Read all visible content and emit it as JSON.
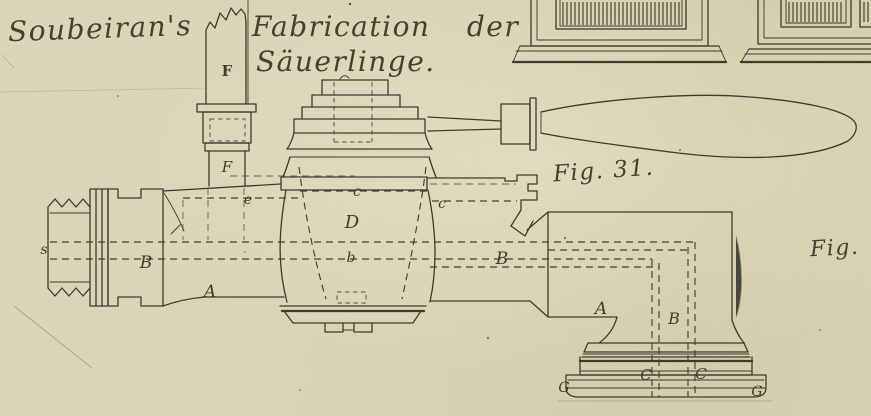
{
  "palette": {
    "paper": "#d8d3b6",
    "ink": "#3e3a2c",
    "faint_ink": "#8d8769",
    "label_ink": "#45402f"
  },
  "titles": {
    "artist": "Soubeiran's",
    "subject_line1": "Fabrication der",
    "subject_line2": "Säuerlinge."
  },
  "figure_labels": {
    "fig31": "Fig. 31.",
    "fig_partial": "Fig."
  },
  "part_labels": [
    {
      "text": "F",
      "x": 227,
      "y": 76,
      "size": 15,
      "variant": "upright"
    },
    {
      "text": "F",
      "x": 227,
      "y": 172,
      "size": 15,
      "variant": "italic"
    },
    {
      "text": "s",
      "x": 44,
      "y": 254,
      "size": 14,
      "variant": "italic"
    },
    {
      "text": "B",
      "x": 146,
      "y": 268,
      "size": 17,
      "variant": "italic"
    },
    {
      "text": "A",
      "x": 210,
      "y": 297,
      "size": 17,
      "variant": "italic"
    },
    {
      "text": "e",
      "x": 248,
      "y": 204,
      "size": 14,
      "variant": "italic"
    },
    {
      "text": "c",
      "x": 357,
      "y": 196,
      "size": 14,
      "variant": "italic"
    },
    {
      "text": "D",
      "x": 352,
      "y": 228,
      "size": 18,
      "variant": "italic"
    },
    {
      "text": "c",
      "x": 442,
      "y": 208,
      "size": 14,
      "variant": "italic"
    },
    {
      "text": "b",
      "x": 351,
      "y": 262,
      "size": 14,
      "variant": "italic"
    },
    {
      "text": "B",
      "x": 502,
      "y": 264,
      "size": 17,
      "variant": "italic"
    },
    {
      "text": "A",
      "x": 601,
      "y": 314,
      "size": 17,
      "variant": "italic"
    },
    {
      "text": "B",
      "x": 674,
      "y": 324,
      "size": 16,
      "variant": "italic"
    },
    {
      "text": "C",
      "x": 646,
      "y": 380,
      "size": 15,
      "variant": "italic"
    },
    {
      "text": "C",
      "x": 701,
      "y": 379,
      "size": 15,
      "variant": "italic"
    },
    {
      "text": "G",
      "x": 564,
      "y": 392,
      "size": 14,
      "variant": "italic"
    },
    {
      "text": "G",
      "x": 757,
      "y": 396,
      "size": 14,
      "variant": "italic"
    }
  ]
}
